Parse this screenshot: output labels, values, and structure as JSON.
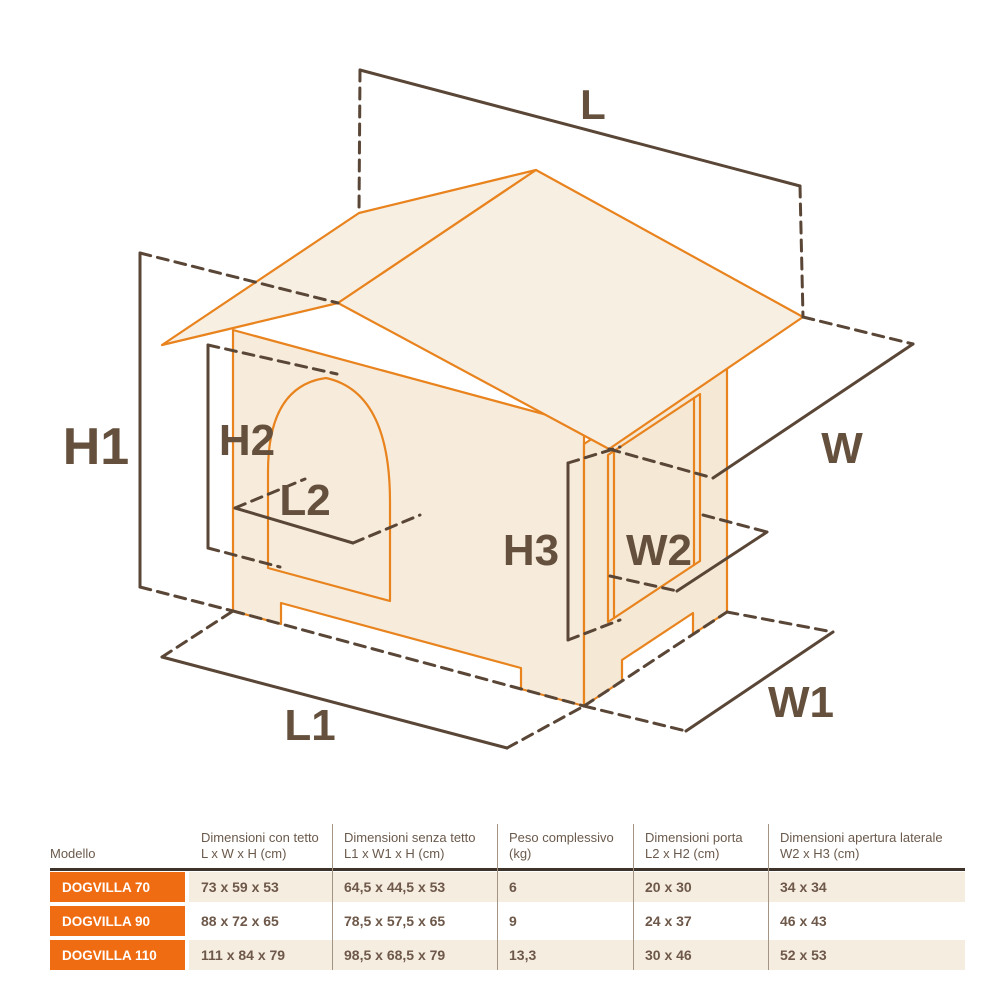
{
  "diagram": {
    "labels": {
      "L": "L",
      "W": "W",
      "H1": "H1",
      "H2": "H2",
      "L2": "L2",
      "H3": "H3",
      "W2": "W2",
      "W1": "W1",
      "L1": "L1"
    },
    "colors": {
      "outline": "#e8831e",
      "roof_fill": "#f8efe3",
      "front_wall_fill": "#f7ecdb",
      "side_wall_fill": "#f5e9d5",
      "dimension_line": "#5a4636",
      "label_text": "#64503c"
    }
  },
  "table": {
    "headers": [
      {
        "line1": "Modello",
        "line2": ""
      },
      {
        "line1": "Dimensioni con tetto",
        "line2": "L x W x H (cm)"
      },
      {
        "line1": "Dimensioni senza tetto",
        "line2": "L1 x W1 x H (cm)"
      },
      {
        "line1": "Peso complessivo",
        "line2": "(kg)"
      },
      {
        "line1": "Dimensioni porta",
        "line2": "L2 x H2 (cm)"
      },
      {
        "line1": "Dimensioni apertura laterale",
        "line2": "W2 x H3 (cm)"
      }
    ],
    "rows": [
      {
        "model": "DOGVILLA 70",
        "values": [
          "73 x 59 x 53",
          "64,5 x 44,5 x 53",
          "6",
          "20 x 30",
          "34 x 34"
        ]
      },
      {
        "model": "DOGVILLA 90",
        "values": [
          "88 x 72 x 65",
          "78,5 x 57,5 x 65",
          "9",
          "24 x 37",
          "46 x 43"
        ]
      },
      {
        "model": "DOGVILLA 110",
        "values": [
          "111 x 84 x 79",
          "98,5 x 68,5 x 79",
          "13,3",
          "30 x 46",
          "52 x 53"
        ]
      }
    ],
    "colors": {
      "row_label_bg": "#ef6c12",
      "row_beige": "#f6ede1",
      "header_rule": "#3e332a"
    }
  }
}
